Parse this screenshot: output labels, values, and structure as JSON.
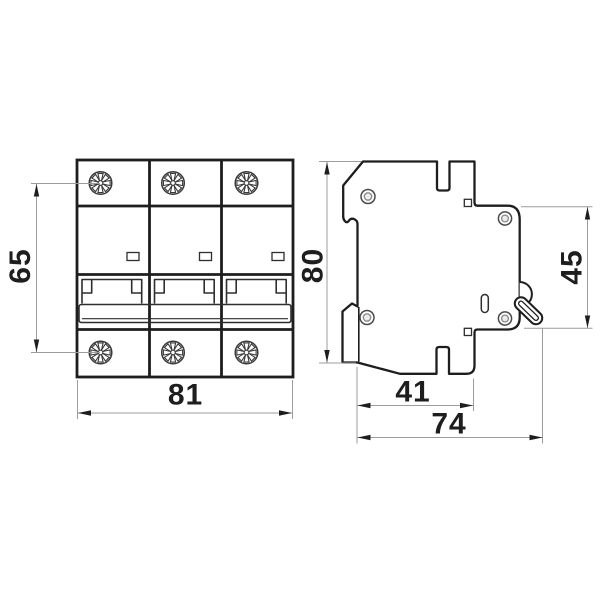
{
  "drawing": {
    "subject": "3-pole modular circuit breaker dimensional drawing",
    "colors": {
      "background": "#ffffff",
      "line": "#1e1e1e",
      "thin_line": "#9c9c9c",
      "text": "#1e1e1e"
    },
    "front_view": {
      "name": "front view",
      "poles": 3,
      "features": [
        "terminal-screws-top",
        "terminal-screws-bottom",
        "indicator-windows",
        "handle-recesses",
        "handle-tie-bar"
      ]
    },
    "side_view": {
      "name": "side view",
      "features": [
        "din-rail-clip",
        "rivets",
        "toggle-lever",
        "face-slot",
        "mounting-slots"
      ]
    },
    "dimensions": {
      "screw_pitch_height": "65",
      "total_width": "81",
      "body_height": "80",
      "front_face_height": "45",
      "body_depth": "41",
      "total_depth": "74"
    }
  }
}
